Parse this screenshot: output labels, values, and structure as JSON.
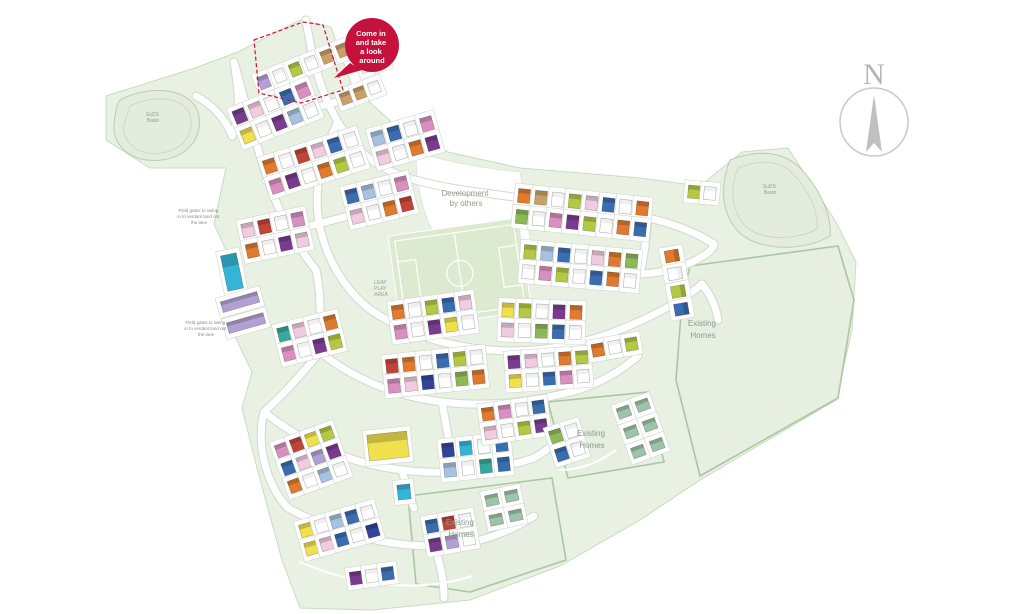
{
  "canvas": {
    "width": 1024,
    "height": 614,
    "background": "#ffffff"
  },
  "badge": {
    "lines": [
      "Come in",
      "and take",
      "a look",
      "around"
    ],
    "color": "#c5123c",
    "text_color": "#ffffff"
  },
  "compass": {
    "letter": "N"
  },
  "labels": {
    "development_by_others": {
      "lines": [
        "Development",
        "by others"
      ]
    },
    "existing_homes": {
      "lines": [
        "Existing",
        "Homes"
      ]
    },
    "leap_play_area": {
      "lines": [
        "LEAP",
        "PLAY",
        "AREA"
      ]
    },
    "suds_basin": {
      "lines": [
        "SuDS",
        "Basin"
      ]
    },
    "field_note": {
      "lines": [
        "Field gates to swing",
        "in to verdant land not",
        "the lane"
      ]
    }
  },
  "colors": {
    "site_green": "#e9f1e3",
    "hedge_green": "#a9c7a0",
    "road_white": "#ffffff",
    "road_casing": "#d2d6d0",
    "pitch_green": "#dcead0",
    "accent_red": "#c5123c",
    "sales_boundary_red": "#d0103a",
    "compass_grey": "#c0c0c0"
  },
  "palette": {
    "P": "#7a3b8f",
    "M": "#d98fc0",
    "K": "#f1cce0",
    "R": "#bf4538",
    "O": "#df7a2e",
    "T": "#c8a068",
    "Y": "#f0e04e",
    "G": "#b4c843",
    "V": "#8db858",
    "C": "#35b5d6",
    "B": "#3a6cb0",
    "L": "#a6c2e0",
    "N": "#32449a",
    "A": "#b2a0d4",
    "Q": "#38a79e",
    "S": "#9dc4a8",
    "W": "#ffffff"
  },
  "house_clusters": [
    {
      "x": 264,
      "y": 82,
      "a": -22,
      "cols": 6,
      "rows": 1,
      "dx": 17,
      "dy": 0,
      "w": 11,
      "h": 13,
      "colors": "AWGWTT"
    },
    {
      "x": 240,
      "y": 116,
      "a": -22,
      "cols": 5,
      "rows": 2,
      "dx": 17,
      "dy": 21,
      "w": 12,
      "h": 14,
      "colors": "PKWBMYWPLW"
    },
    {
      "x": 270,
      "y": 166,
      "a": -18,
      "cols": 6,
      "rows": 2,
      "dx": 17,
      "dy": 21,
      "w": 12,
      "h": 14,
      "colors": "OWRKBWMPWOGW"
    },
    {
      "x": 248,
      "y": 230,
      "a": -12,
      "cols": 4,
      "rows": 2,
      "dx": 17,
      "dy": 21,
      "w": 12,
      "h": 14,
      "colors": "KRWMOWPK"
    },
    {
      "x": 232,
      "y": 272,
      "a": -12,
      "cols": 1,
      "rows": 1,
      "dx": 0,
      "dy": 0,
      "w": 16,
      "h": 36,
      "colors": "C"
    },
    {
      "x": 240,
      "y": 302,
      "a": -16,
      "cols": 1,
      "rows": 2,
      "dx": 0,
      "dy": 22,
      "w": 38,
      "h": 11,
      "colors": "AA"
    },
    {
      "x": 284,
      "y": 334,
      "a": -14,
      "cols": 4,
      "rows": 2,
      "dx": 16,
      "dy": 20,
      "w": 12,
      "h": 14,
      "colors": "QKWOMWPG"
    },
    {
      "x": 352,
      "y": 196,
      "a": -14,
      "cols": 4,
      "rows": 2,
      "dx": 17,
      "dy": 21,
      "w": 12,
      "h": 14,
      "colors": "BLWMKWOR"
    },
    {
      "x": 398,
      "y": 312,
      "a": -8,
      "cols": 5,
      "rows": 2,
      "dx": 17,
      "dy": 20,
      "w": 12,
      "h": 14,
      "colors": "OWGBKMWPYW"
    },
    {
      "x": 392,
      "y": 366,
      "a": -6,
      "cols": 6,
      "rows": 2,
      "dx": 17,
      "dy": 20,
      "w": 12,
      "h": 14,
      "colors": "ROWBGWMKNWVO"
    },
    {
      "x": 388,
      "y": 446,
      "a": -6,
      "cols": 1,
      "rows": 1,
      "dx": 0,
      "dy": 0,
      "w": 40,
      "h": 26,
      "colors": "Y"
    },
    {
      "x": 448,
      "y": 450,
      "a": -6,
      "cols": 4,
      "rows": 2,
      "dx": 18,
      "dy": 20,
      "w": 12,
      "h": 14,
      "colors": "NCWBLWQB"
    },
    {
      "x": 282,
      "y": 450,
      "a": -20,
      "cols": 4,
      "rows": 3,
      "dx": 16,
      "dy": 19,
      "w": 12,
      "h": 13,
      "colors": "MRYGBKAPOWLW"
    },
    {
      "x": 306,
      "y": 530,
      "a": -16,
      "cols": 5,
      "rows": 2,
      "dx": 16,
      "dy": 19,
      "w": 12,
      "h": 13,
      "colors": "YWLBWYKBWN"
    },
    {
      "x": 432,
      "y": 526,
      "a": -10,
      "cols": 3,
      "rows": 2,
      "dx": 17,
      "dy": 19,
      "w": 12,
      "h": 13,
      "colors": "BRWPAW"
    },
    {
      "x": 524,
      "y": 196,
      "a": 6,
      "cols": 8,
      "rows": 2,
      "dx": 17,
      "dy": 21,
      "w": 12,
      "h": 14,
      "colors": "OTWGKBWOVWMPGWOB"
    },
    {
      "x": 530,
      "y": 252,
      "a": 5,
      "cols": 7,
      "rows": 2,
      "dx": 17,
      "dy": 20,
      "w": 12,
      "h": 14,
      "colors": "GLBWKOVWMGWBOW"
    },
    {
      "x": 508,
      "y": 310,
      "a": 2,
      "cols": 5,
      "rows": 2,
      "dx": 17,
      "dy": 20,
      "w": 12,
      "h": 14,
      "colors": "YGWPOKWVBW"
    },
    {
      "x": 672,
      "y": 256,
      "a": 80,
      "cols": 4,
      "rows": 1,
      "dx": 18,
      "dy": 0,
      "w": 12,
      "h": 14,
      "colors": "OWGB"
    },
    {
      "x": 514,
      "y": 362,
      "a": -4,
      "cols": 5,
      "rows": 2,
      "dx": 17,
      "dy": 19,
      "w": 12,
      "h": 13,
      "colors": "PKWOGYWBMW"
    },
    {
      "x": 488,
      "y": 414,
      "a": -8,
      "cols": 4,
      "rows": 2,
      "dx": 17,
      "dy": 19,
      "w": 12,
      "h": 13,
      "colors": "OMWBKWGP"
    },
    {
      "x": 624,
      "y": 412,
      "a": -20,
      "cols": 2,
      "rows": 3,
      "dx": 20,
      "dy": 21,
      "w": 13,
      "h": 11,
      "colors": "SSSSSS"
    },
    {
      "x": 492,
      "y": 500,
      "a": -12,
      "cols": 2,
      "rows": 2,
      "dx": 20,
      "dy": 20,
      "w": 13,
      "h": 11,
      "colors": "SSSS"
    },
    {
      "x": 378,
      "y": 138,
      "a": -16,
      "cols": 4,
      "rows": 2,
      "dx": 17,
      "dy": 20,
      "w": 12,
      "h": 14,
      "colors": "LBWMKWOP"
    },
    {
      "x": 346,
      "y": 98,
      "a": -20,
      "cols": 3,
      "rows": 1,
      "dx": 15,
      "dy": 0,
      "w": 11,
      "h": 12,
      "colors": "TTW"
    },
    {
      "x": 366,
      "y": 66,
      "a": -20,
      "cols": 2,
      "rows": 1,
      "dx": 16,
      "dy": 0,
      "w": 11,
      "h": 12,
      "colors": "WO"
    },
    {
      "x": 694,
      "y": 192,
      "a": 5,
      "cols": 2,
      "rows": 1,
      "dx": 16,
      "dy": 0,
      "w": 12,
      "h": 13,
      "colors": "GW"
    },
    {
      "x": 556,
      "y": 436,
      "a": -18,
      "cols": 2,
      "rows": 2,
      "dx": 17,
      "dy": 19,
      "w": 12,
      "h": 13,
      "colors": "VWBW"
    },
    {
      "x": 404,
      "y": 492,
      "a": -6,
      "cols": 1,
      "rows": 1,
      "dx": 0,
      "dy": 0,
      "w": 13,
      "h": 15,
      "colors": "C"
    },
    {
      "x": 356,
      "y": 578,
      "a": -8,
      "cols": 3,
      "rows": 1,
      "dx": 16,
      "dy": 0,
      "w": 12,
      "h": 13,
      "colors": "PWB"
    },
    {
      "x": 598,
      "y": 350,
      "a": -10,
      "cols": 3,
      "rows": 1,
      "dx": 17,
      "dy": 0,
      "w": 12,
      "h": 13,
      "colors": "OWG"
    }
  ]
}
